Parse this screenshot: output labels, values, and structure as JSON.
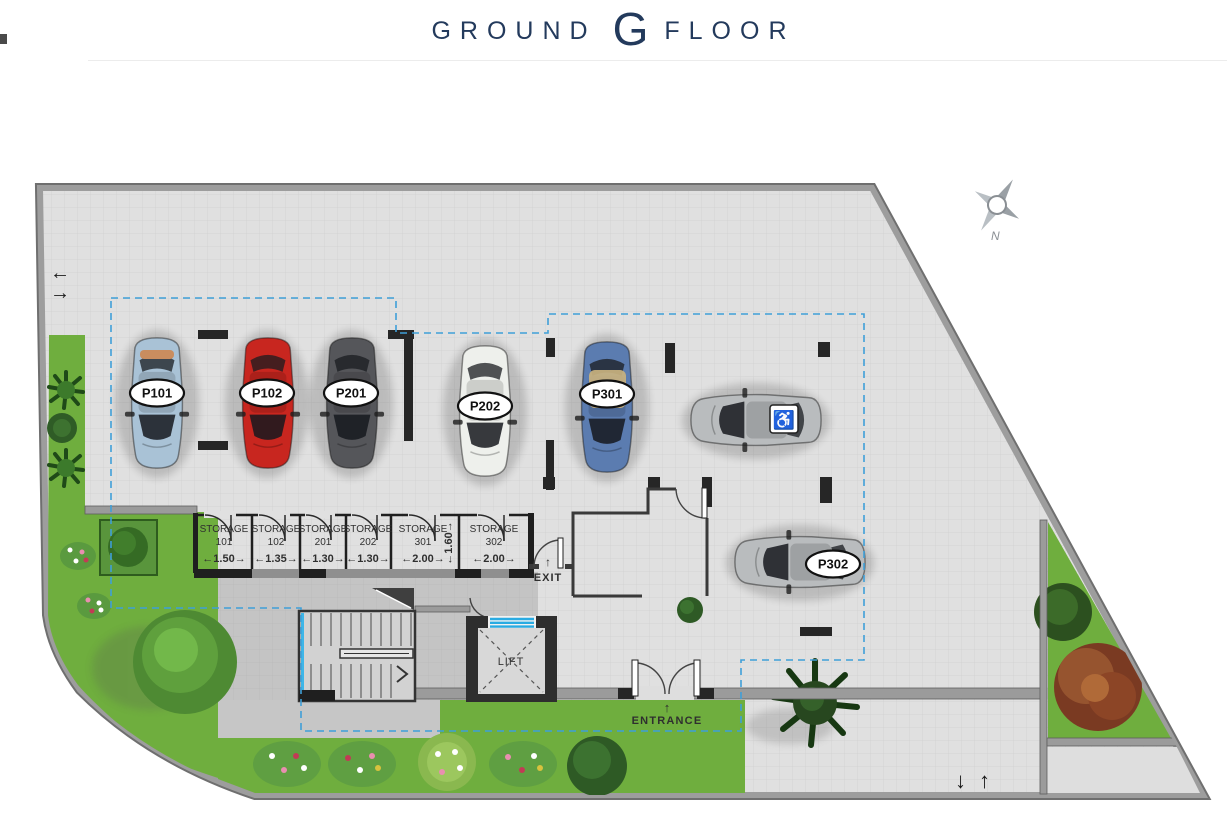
{
  "header": {
    "title_pre": "GROUND",
    "title_g": "G",
    "title_post": "FLOOR"
  },
  "plan": {
    "parking_spots": [
      {
        "id": "P101",
        "color": "#a9c2d6"
      },
      {
        "id": "P102",
        "color": "#c8261f"
      },
      {
        "id": "P201",
        "color": "#55565a"
      },
      {
        "id": "P202",
        "color": "#eef0ec"
      },
      {
        "id": "P301",
        "color": "#5b7cb0"
      },
      {
        "id": "P302",
        "color": "#b9bcbe"
      },
      {
        "id": "accessible-spot",
        "symbol": "♿",
        "color": "#b9bcbe"
      }
    ],
    "storage_units": [
      {
        "name": "STORAGE",
        "number": "101",
        "width_label": "←1.50→"
      },
      {
        "name": "STORAGE",
        "number": "102",
        "width_label": "←1.35→"
      },
      {
        "name": "STORAGE",
        "number": "201",
        "width_label": "←1.30→"
      },
      {
        "name": "STORAGE",
        "number": "202",
        "width_label": "←1.30→"
      },
      {
        "name": "STORAGE",
        "number": "301",
        "width_label": "←2.00→",
        "depth_label": "←1.60→"
      },
      {
        "name": "STORAGE",
        "number": "302",
        "width_label": "←2.00→"
      }
    ],
    "labels": {
      "lift": "LIFT",
      "exit": "EXIT",
      "entrance": "ENTRANCE",
      "north": "N"
    },
    "arrows": {
      "left": "←",
      "right": "→",
      "down": "↓",
      "up": "↑"
    }
  },
  "colors": {
    "navy": "#233a5c",
    "outline_dashed": "#3f9fd8",
    "lift_door": "#29abe2",
    "wall_dark": "#262626",
    "wall_gray": "#9b9b9b",
    "paving": "#e0e0e0",
    "grass": "#6fae3e"
  }
}
